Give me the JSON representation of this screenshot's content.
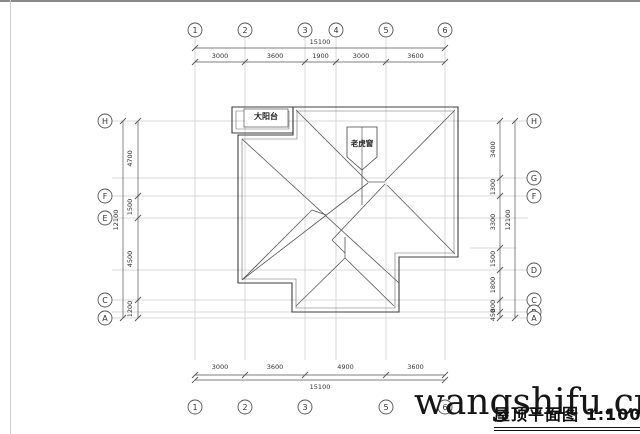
{
  "drawing_title": {
    "label": "屋顶平面图",
    "scale": "1:100"
  },
  "watermark": {
    "text": "wangshifu.cn"
  },
  "roof_labels": {
    "balcony": "大阳台",
    "dormer": "老虎窗"
  },
  "grid_axes": {
    "top": [
      "1",
      "2",
      "3",
      "4",
      "5",
      "6"
    ],
    "bottom": [
      "1",
      "2",
      "3",
      "5",
      "6"
    ],
    "left": [
      "H",
      "F",
      "E",
      "C",
      "A"
    ],
    "right": [
      "H",
      "G",
      "F",
      "D",
      "C",
      "B",
      "A"
    ]
  },
  "dimensions": {
    "top_total": "15100",
    "top_segments": [
      "3000",
      "3600",
      "1900",
      "3000",
      "3600"
    ],
    "bottom_total": "15100",
    "bottom_segments": [
      "3000",
      "3600",
      "4900",
      "3600"
    ],
    "left_total": "12100",
    "left_segments": [
      "4700",
      "1500",
      "4500",
      "1200"
    ],
    "right_total": "12100",
    "right_segments": [
      "3400",
      "1300",
      "3300",
      "1500",
      "1800",
      "800",
      "450"
    ]
  },
  "colors": {
    "roof_line": "#3f3f3f",
    "inner_line": "#6a6a6a",
    "grid_line": "#d8d8d8",
    "dim_line": "#555555",
    "text": "#333333",
    "watermark": "#161616"
  }
}
